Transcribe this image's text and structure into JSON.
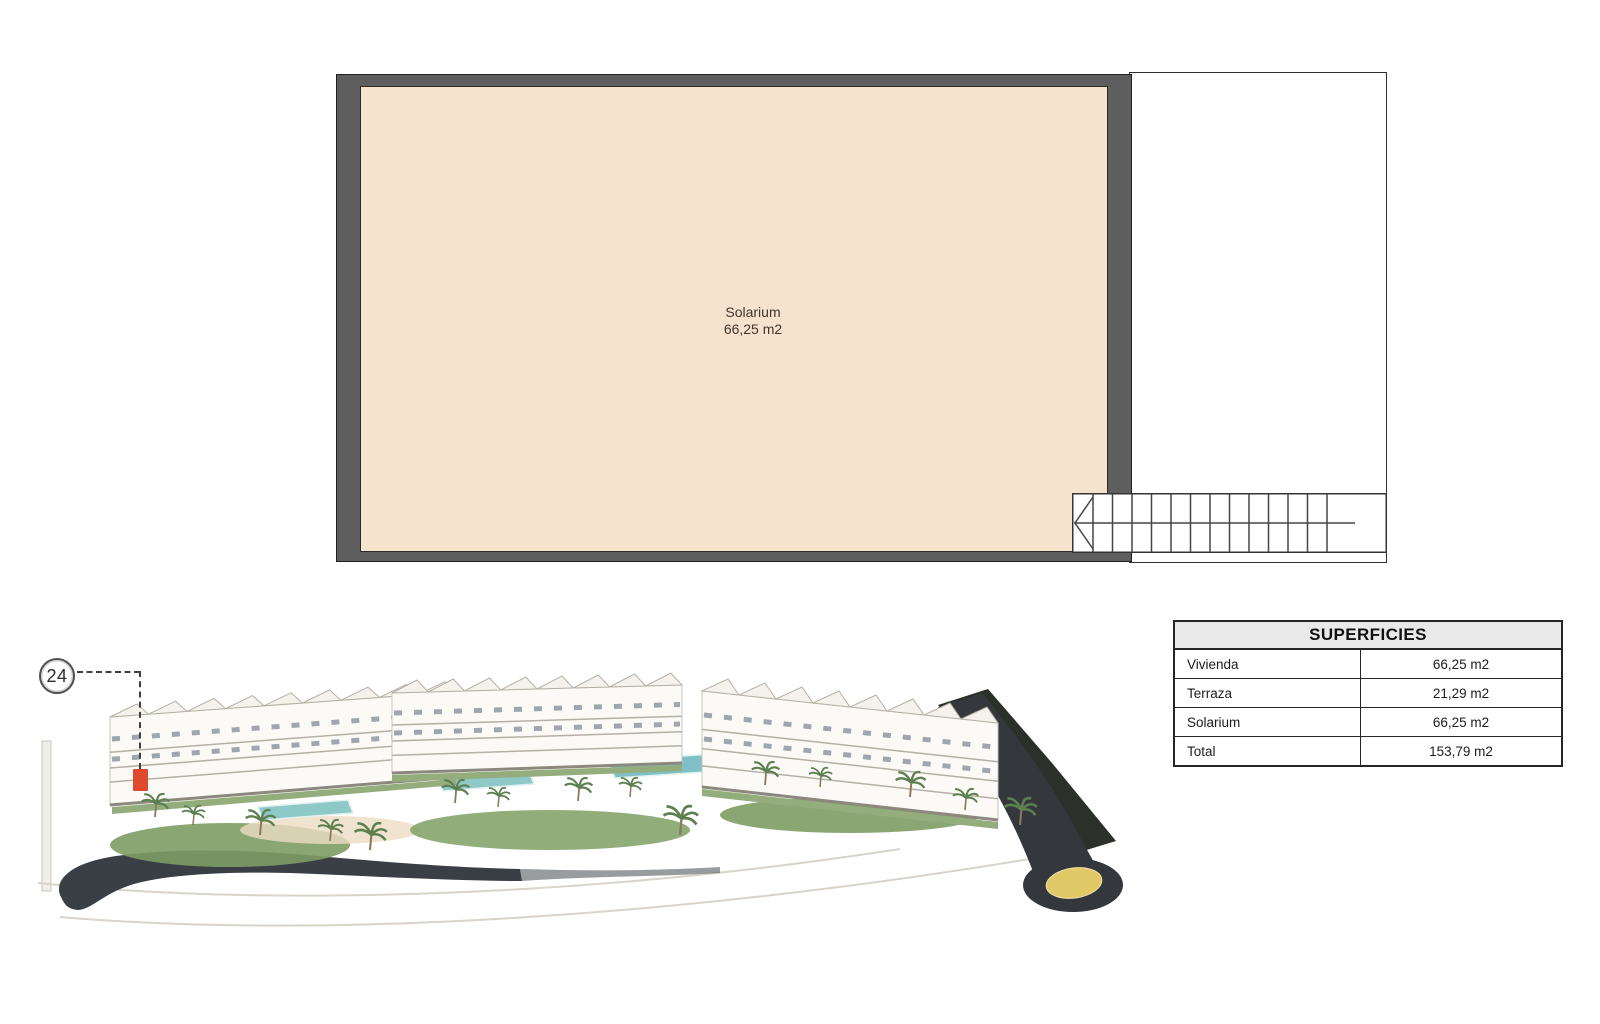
{
  "plan": {
    "room": {
      "label": "Solarium",
      "area": "66,25 m2"
    }
  },
  "marker": {
    "number": "24"
  },
  "table": {
    "title": "SUPERFICIES",
    "rows": [
      {
        "label": "Vivienda",
        "value": "66,25 m2"
      },
      {
        "label": "Terraza",
        "value": "21,29 m2"
      },
      {
        "label": "Solarium",
        "value": "66,25 m2"
      },
      {
        "label": "Total",
        "value": "153,79 m2"
      }
    ]
  },
  "colors": {
    "room_fill": "#f6e3ce",
    "wall_gray": "#5e5e5e",
    "unit_highlight_red": "#dd4a2e",
    "roundabout_yellow": "#e2c967",
    "table_header_bg": "#e9e9e9"
  }
}
